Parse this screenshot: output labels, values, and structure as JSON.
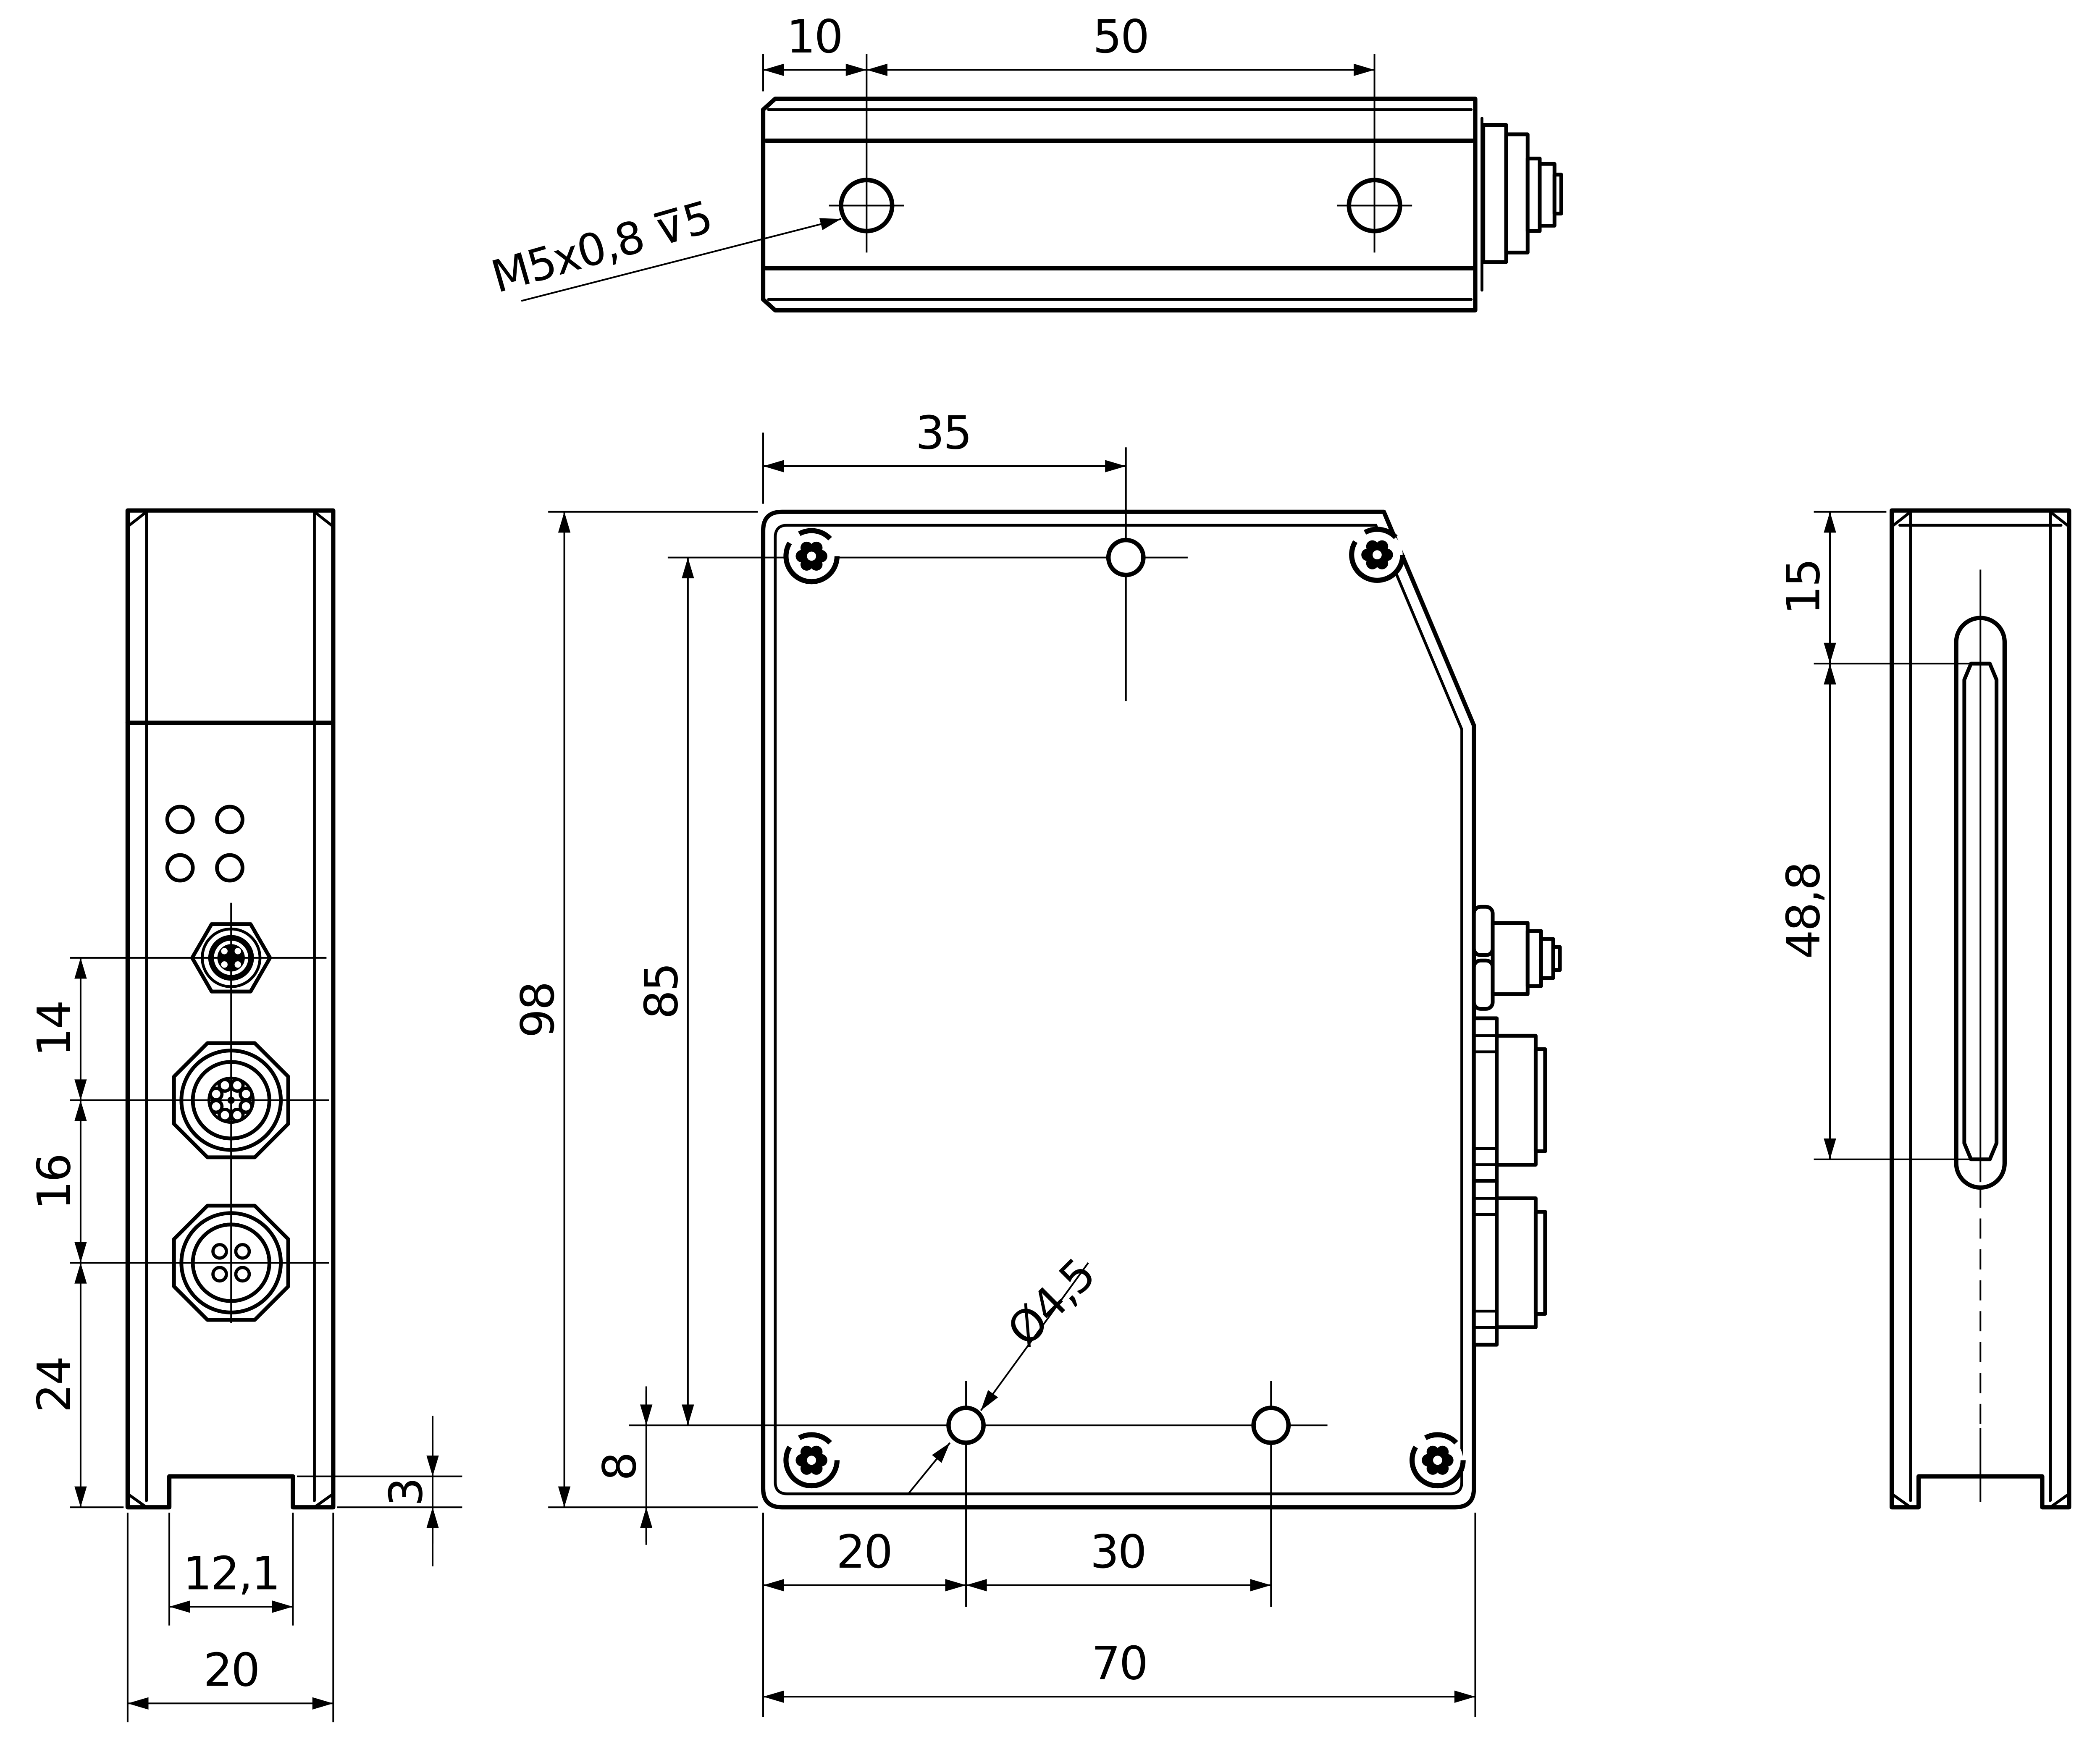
{
  "colors": {
    "line": "#000000",
    "background": "#ffffff"
  },
  "dims": {
    "top_view": {
      "hole_offset": "10",
      "hole_spacing": "50",
      "thread_callout": "M5x0,8 ⊽5"
    },
    "front_view": {
      "top_hole_offset": "35",
      "body_height": "98",
      "hole_rows_span": "85",
      "bottom_hole_height": "8",
      "bottom_hole_offset": "20",
      "bottom_hole_spacing": "30",
      "body_width": "70",
      "hole_diameter": "Ø4,5"
    },
    "left_view": {
      "m5_to_m12": "14",
      "m12_to_m12": "16",
      "m12_to_bottom": "24",
      "groove_depth": "3",
      "groove_width": "12,1",
      "body_depth": "20"
    },
    "right_view": {
      "slot_top_offset": "15",
      "slot_length": "48,8"
    }
  }
}
